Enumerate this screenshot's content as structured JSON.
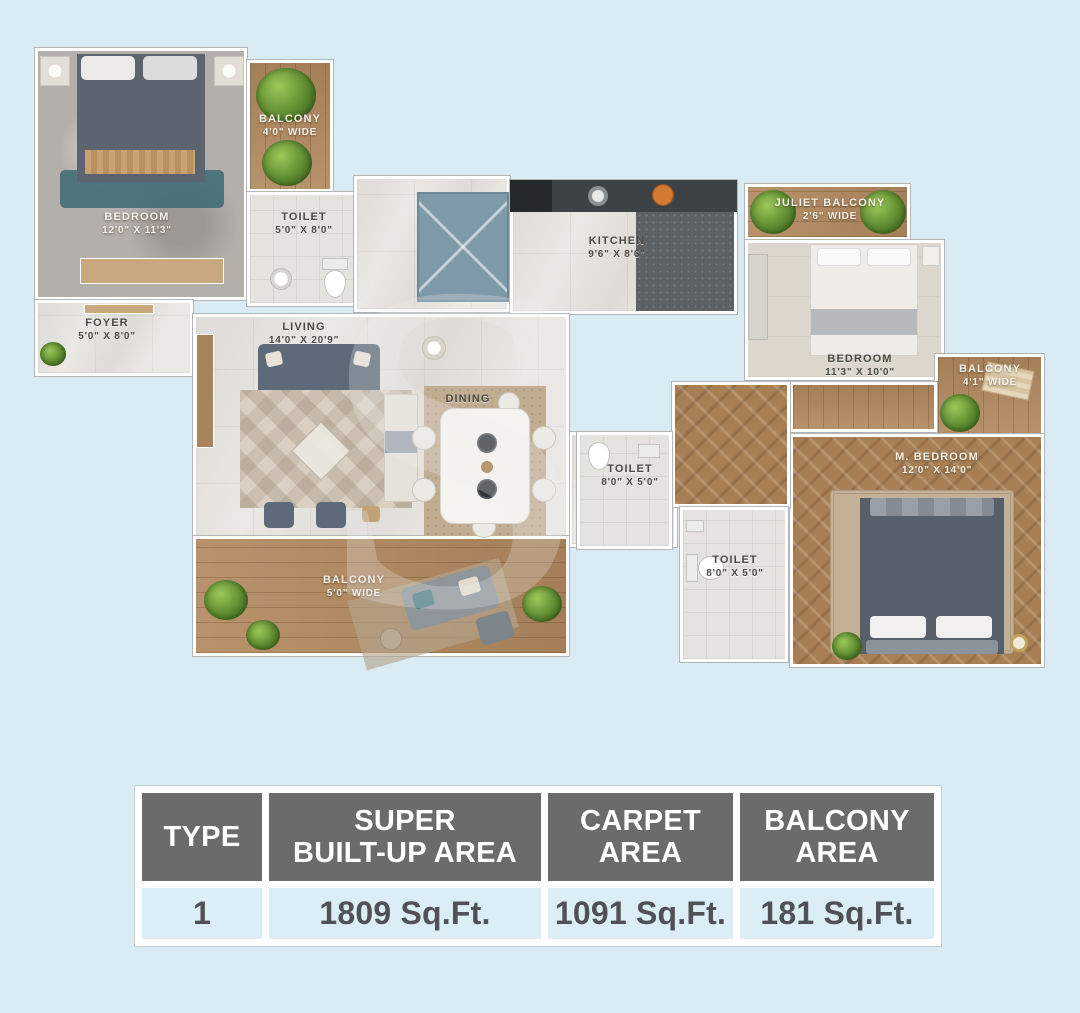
{
  "watermark": "S",
  "colors": {
    "page_bg": "#d9ecf4",
    "table_header_bg": "#6b6b6b",
    "table_header_text": "#ffffff",
    "table_row_bg": "#dceef5",
    "table_row_text": "#4f5156",
    "wood_floor": "#b2895f",
    "marble_floor": "#eae8e4",
    "shaft_blue": "#7e99a7"
  },
  "floorplan": {
    "rooms": [
      {
        "name": "BEDROOM",
        "dims": "12'0\" X 11'3\""
      },
      {
        "name": "BALCONY",
        "dims": "4'0\" WIDE"
      },
      {
        "name": "TOILET",
        "dims": "5'0\" X 8'0\""
      },
      {
        "name": "KITCHEN",
        "dims": "9'6\" X 8'6\""
      },
      {
        "name": "JULIET BALCONY",
        "dims": "2'6\" WIDE"
      },
      {
        "name": "BEDROOM",
        "dims": "11'3\" X 10'0\""
      },
      {
        "name": "BALCONY",
        "dims": "4'1\" WIDE"
      },
      {
        "name": "M. BEDROOM",
        "dims": "12'0\" X 14'0\""
      },
      {
        "name": "TOILET",
        "dims": "8'0\" X 5'0\""
      },
      {
        "name": "TOILET",
        "dims": "8'0\" X 5'0\""
      },
      {
        "name": "FOYER",
        "dims": "5'0\" X 8'0\""
      },
      {
        "name": "LIVING",
        "dims": "14'0\" X 20'9\""
      },
      {
        "name": "DINING",
        "dims": ""
      },
      {
        "name": "BALCONY",
        "dims": "5'0\" WIDE"
      }
    ]
  },
  "table": {
    "headers": [
      "TYPE",
      "SUPER\nBUILT-UP AREA",
      "CARPET\nAREA",
      "BALCONY\nAREA"
    ],
    "row": [
      "1",
      "1809 Sq.Ft.",
      "1091 Sq.Ft.",
      "181 Sq.Ft."
    ]
  }
}
